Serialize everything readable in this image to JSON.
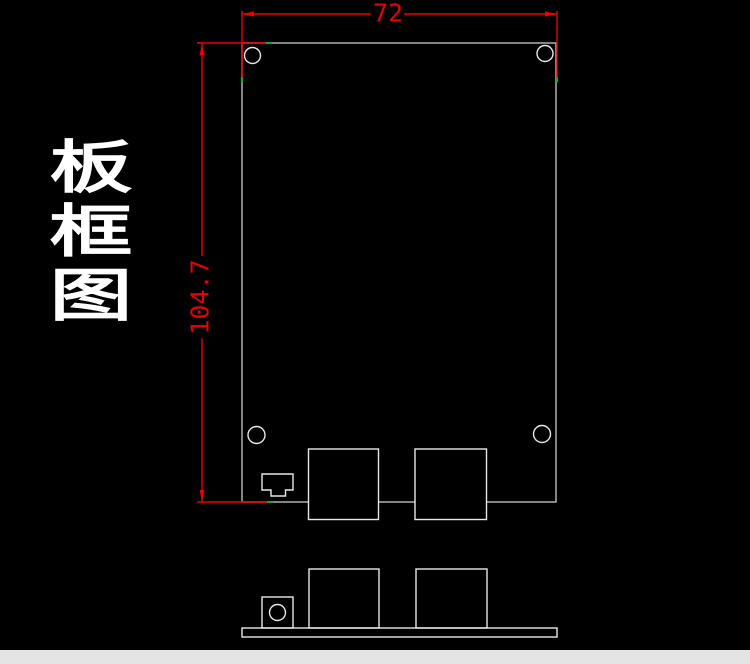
{
  "title": {
    "text": "板框图",
    "chars": [
      "板",
      "框",
      "图"
    ]
  },
  "dimensions": {
    "width": {
      "label": "72"
    },
    "height": {
      "label": "104.7"
    }
  },
  "colors": {
    "background": "#000000",
    "dimension": "#e60000",
    "snap_marker": "#00a651",
    "board_outline": "#b0b0b0",
    "component_outline": "#e8e8e8",
    "title_text": "#ffffff",
    "footer_strip": "#e4e4e4"
  }
}
